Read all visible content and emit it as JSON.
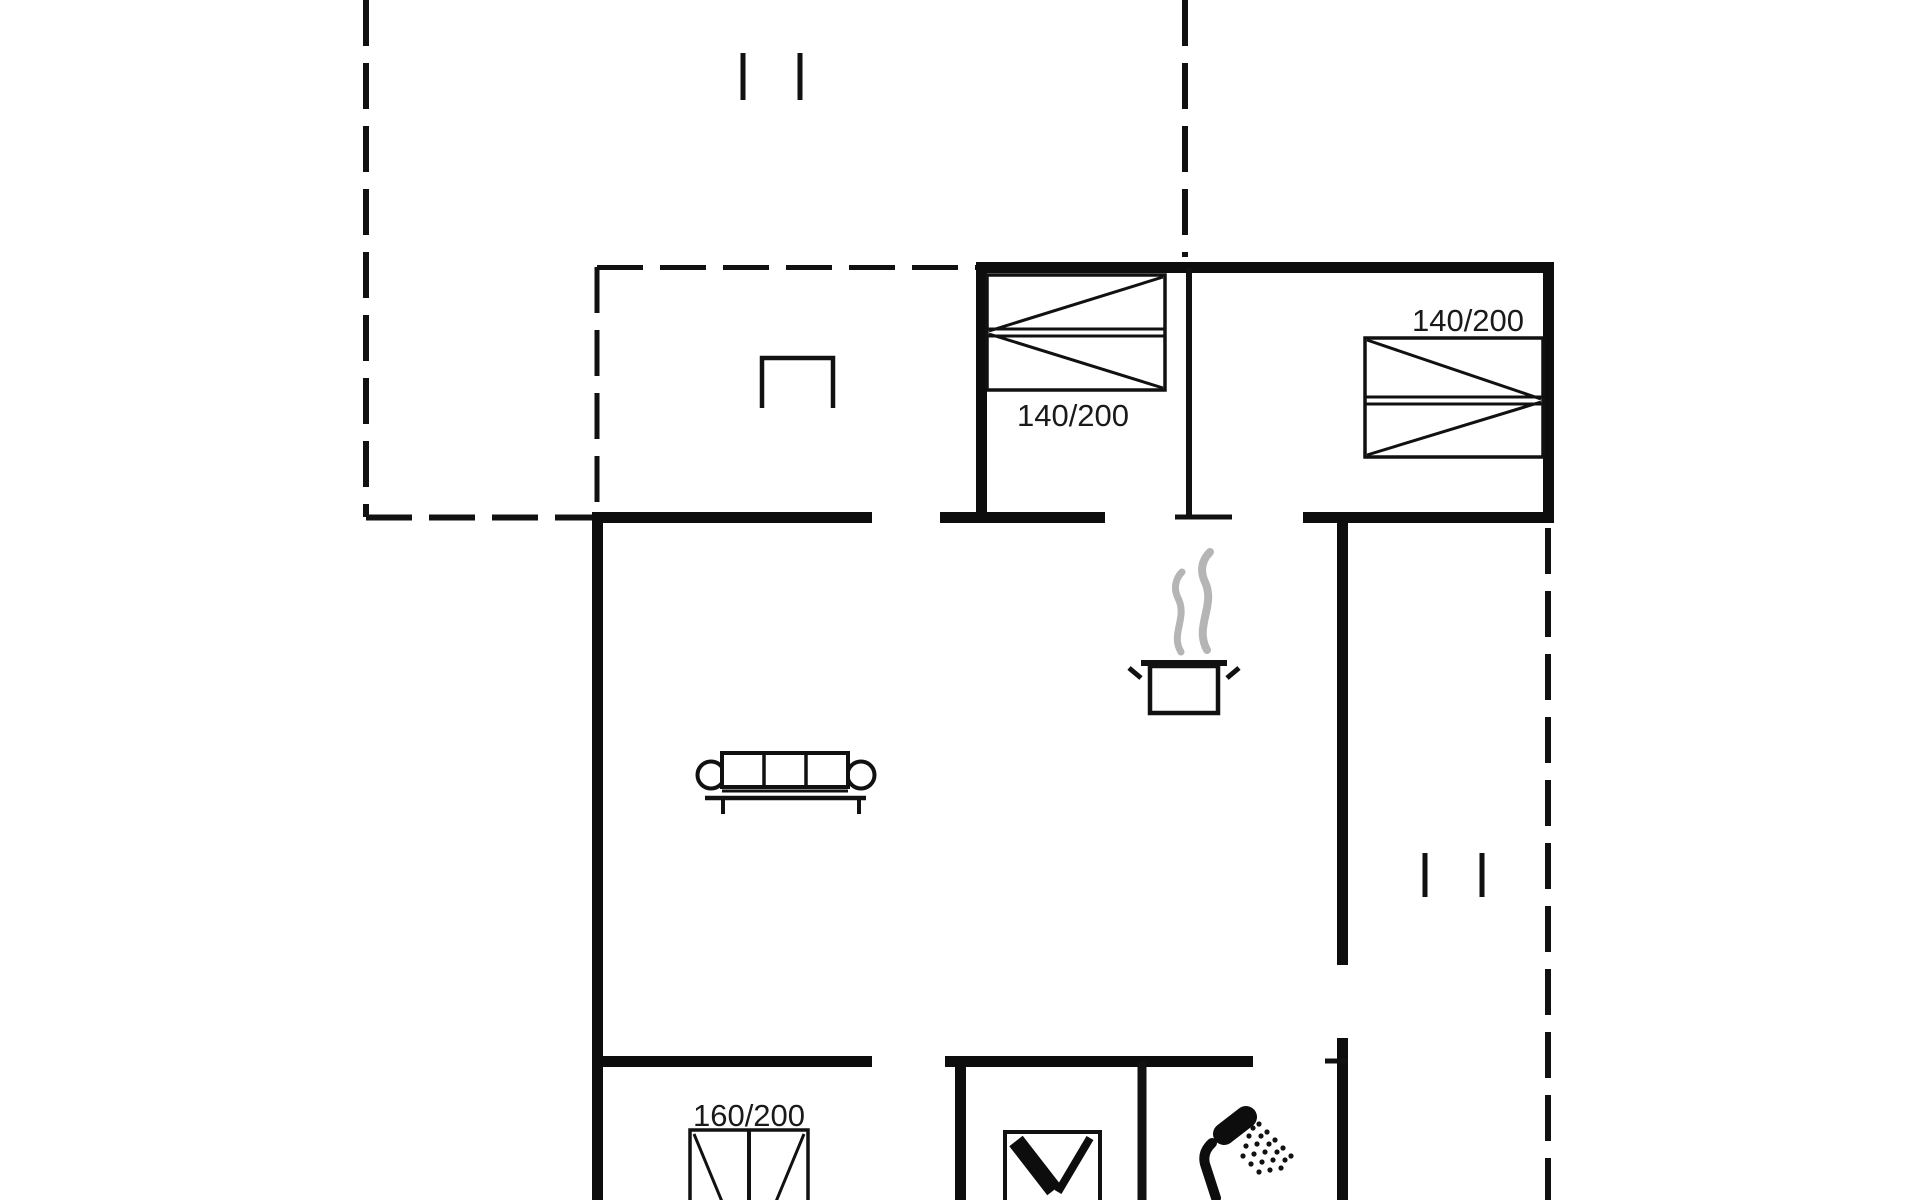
{
  "page": {
    "title": "Holiday house floor plan",
    "background": "#ffffff"
  },
  "colors": {
    "wall": "#0d0d0d",
    "line": "#111111",
    "text": "#1a1a1a",
    "steam": "#b5b5b5",
    "fill": "#ffffff"
  },
  "rooms": {
    "bedroom_top_left": {
      "bed_label": "140/200"
    },
    "bedroom_top_right": {
      "bed_label": "140/200"
    },
    "bedroom_bottom": {
      "bed_label": "160/200"
    }
  },
  "symbols": {
    "beds": [
      "double-bed-icon",
      "double-bed-icon",
      "double-bed-icon"
    ],
    "living": [
      "sofa-icon",
      "chair-icon"
    ],
    "kitchen": [
      "cooking-pot-icon",
      "steam-icon"
    ],
    "bathroom": [
      "toilet-icon",
      "shower-icon"
    ],
    "marks": [
      "window-mark-icon",
      "window-mark-icon",
      "window-mark-icon",
      "window-mark-icon"
    ],
    "outline": [
      "dashed-terrace-outline",
      "dashed-entry-outline"
    ]
  }
}
